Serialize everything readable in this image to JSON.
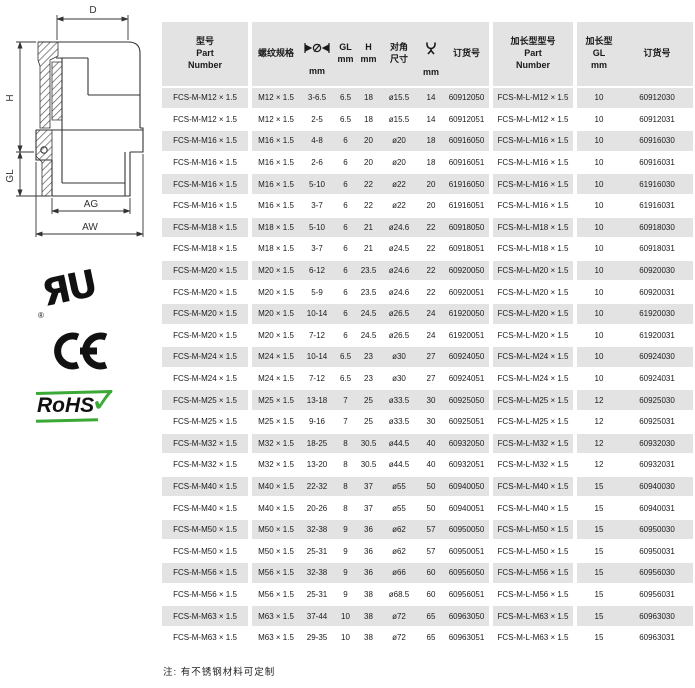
{
  "drawing": {
    "labels": {
      "d": "D",
      "h": "H",
      "gl": "GL",
      "ag": "AG",
      "aw": "AW"
    }
  },
  "certifications": {
    "ul_mark": "ЯU",
    "ul_registered": "®",
    "ce": "CE",
    "rohs": "RoHS",
    "rohs_check": "✓"
  },
  "table": {
    "stripe_color": "#e3e3e3",
    "header": {
      "part_number": "型号\nPart\nNumber",
      "thread_spec": "螺纹规格",
      "clamp_icon": "clamp-range-diameter",
      "clamp_unit": "mm",
      "gl": "GL\nmm",
      "h": "H\nmm",
      "diagonal": "对角\n尺寸",
      "wrench_icon": "wrench-size",
      "wrench_unit": "mm",
      "order_no": "订货号",
      "ext_part_number": "加长型型号\nPart\nNumber",
      "ext_gl": "加长型\nGL\nmm",
      "ext_order_no": "订货号"
    },
    "rows": [
      [
        "FCS-M-M12 × 1.5",
        "M12 × 1.5",
        "3-6.5",
        "6.5",
        "18",
        "ø15.5",
        "14",
        "60912050",
        "FCS-M-L-M12 × 1.5",
        "10",
        "60912030"
      ],
      [
        "FCS-M-M12 × 1.5",
        "M12 × 1.5",
        "2-5",
        "6.5",
        "18",
        "ø15.5",
        "14",
        "60912051",
        "FCS-M-L-M12 × 1.5",
        "10",
        "60912031"
      ],
      [
        "FCS-M-M16 × 1.5",
        "M16 × 1.5",
        "4-8",
        "6",
        "20",
        "ø20",
        "18",
        "60916050",
        "FCS-M-L-M16 × 1.5",
        "10",
        "60916030"
      ],
      [
        "FCS-M-M16 × 1.5",
        "M16 × 1.5",
        "2-6",
        "6",
        "20",
        "ø20",
        "18",
        "60916051",
        "FCS-M-L-M16 × 1.5",
        "10",
        "60916031"
      ],
      [
        "FCS-M-M16 × 1.5",
        "M16 × 1.5",
        "5-10",
        "6",
        "22",
        "ø22",
        "20",
        "61916050",
        "FCS-M-L-M16 × 1.5",
        "10",
        "61916030"
      ],
      [
        "FCS-M-M16 × 1.5",
        "M16 × 1.5",
        "3-7",
        "6",
        "22",
        "ø22",
        "20",
        "61916051",
        "FCS-M-L-M16 × 1.5",
        "10",
        "61916031"
      ],
      [
        "FCS-M-M18 × 1.5",
        "M18 × 1.5",
        "5-10",
        "6",
        "21",
        "ø24.6",
        "22",
        "60918050",
        "FCS-M-L-M18 × 1.5",
        "10",
        "60918030"
      ],
      [
        "FCS-M-M18 × 1.5",
        "M18 × 1.5",
        "3-7",
        "6",
        "21",
        "ø24.5",
        "22",
        "60918051",
        "FCS-M-L-M18 × 1.5",
        "10",
        "60918031"
      ],
      [
        "FCS-M-M20 × 1.5",
        "M20 × 1.5",
        "6-12",
        "6",
        "23.5",
        "ø24.6",
        "22",
        "60920050",
        "FCS-M-L-M20 × 1.5",
        "10",
        "60920030"
      ],
      [
        "FCS-M-M20 × 1.5",
        "M20 × 1.5",
        "5-9",
        "6",
        "23.5",
        "ø24.6",
        "22",
        "60920051",
        "FCS-M-L-M20 × 1.5",
        "10",
        "60920031"
      ],
      [
        "FCS-M-M20 × 1.5",
        "M20 × 1.5",
        "10-14",
        "6",
        "24.5",
        "ø26.5",
        "24",
        "61920050",
        "FCS-M-L-M20 × 1.5",
        "10",
        "61920030"
      ],
      [
        "FCS-M-M20 × 1.5",
        "M20 × 1.5",
        "7-12",
        "6",
        "24.5",
        "ø26.5",
        "24",
        "61920051",
        "FCS-M-L-M20 × 1.5",
        "10",
        "61920031"
      ],
      [
        "FCS-M-M24 × 1.5",
        "M24 × 1.5",
        "10-14",
        "6.5",
        "23",
        "ø30",
        "27",
        "60924050",
        "FCS-M-L-M24 × 1.5",
        "10",
        "60924030"
      ],
      [
        "FCS-M-M24 × 1.5",
        "M24 × 1.5",
        "7-12",
        "6.5",
        "23",
        "ø30",
        "27",
        "60924051",
        "FCS-M-L-M24 × 1.5",
        "10",
        "60924031"
      ],
      [
        "FCS-M-M25 × 1.5",
        "M25 × 1.5",
        "13-18",
        "7",
        "25",
        "ø33.5",
        "30",
        "60925050",
        "FCS-M-L-M25 × 1.5",
        "12",
        "60925030"
      ],
      [
        "FCS-M-M25 × 1.5",
        "M25 × 1.5",
        "9-16",
        "7",
        "25",
        "ø33.5",
        "30",
        "60925051",
        "FCS-M-L-M25 × 1.5",
        "12",
        "60925031"
      ],
      [
        "FCS-M-M32 × 1.5",
        "M32 × 1.5",
        "18-25",
        "8",
        "30.5",
        "ø44.5",
        "40",
        "60932050",
        "FCS-M-L-M32 × 1.5",
        "12",
        "60932030"
      ],
      [
        "FCS-M-M32 × 1.5",
        "M32 × 1.5",
        "13-20",
        "8",
        "30.5",
        "ø44.5",
        "40",
        "60932051",
        "FCS-M-L-M32 × 1.5",
        "12",
        "60932031"
      ],
      [
        "FCS-M-M40 × 1.5",
        "M40 × 1.5",
        "22-32",
        "8",
        "37",
        "ø55",
        "50",
        "60940050",
        "FCS-M-L-M40 × 1.5",
        "15",
        "60940030"
      ],
      [
        "FCS-M-M40 × 1.5",
        "M40 × 1.5",
        "20-26",
        "8",
        "37",
        "ø55",
        "50",
        "60940051",
        "FCS-M-L-M40 × 1.5",
        "15",
        "60940031"
      ],
      [
        "FCS-M-M50 × 1.5",
        "M50 × 1.5",
        "32-38",
        "9",
        "36",
        "ø62",
        "57",
        "60950050",
        "FCS-M-L-M50 × 1.5",
        "15",
        "60950030"
      ],
      [
        "FCS-M-M50 × 1.5",
        "M50 × 1.5",
        "25-31",
        "9",
        "36",
        "ø62",
        "57",
        "60950051",
        "FCS-M-L-M50 × 1.5",
        "15",
        "60950031"
      ],
      [
        "FCS-M-M56 × 1.5",
        "M56 × 1.5",
        "32-38",
        "9",
        "36",
        "ø66",
        "60",
        "60956050",
        "FCS-M-L-M56 × 1.5",
        "15",
        "60956030"
      ],
      [
        "FCS-M-M56 × 1.5",
        "M56 × 1.5",
        "25-31",
        "9",
        "38",
        "ø68.5",
        "60",
        "60956051",
        "FCS-M-L-M56 × 1.5",
        "15",
        "60956031"
      ],
      [
        "FCS-M-M63 × 1.5",
        "M63 × 1.5",
        "37-44",
        "10",
        "38",
        "ø72",
        "65",
        "60963050",
        "FCS-M-L-M63 × 1.5",
        "15",
        "60963030"
      ],
      [
        "FCS-M-M63 × 1.5",
        "M63 × 1.5",
        "29-35",
        "10",
        "38",
        "ø72",
        "65",
        "60963051",
        "FCS-M-L-M63 × 1.5",
        "15",
        "60963031"
      ]
    ]
  },
  "note": "注: 有不锈钢材料可定制"
}
